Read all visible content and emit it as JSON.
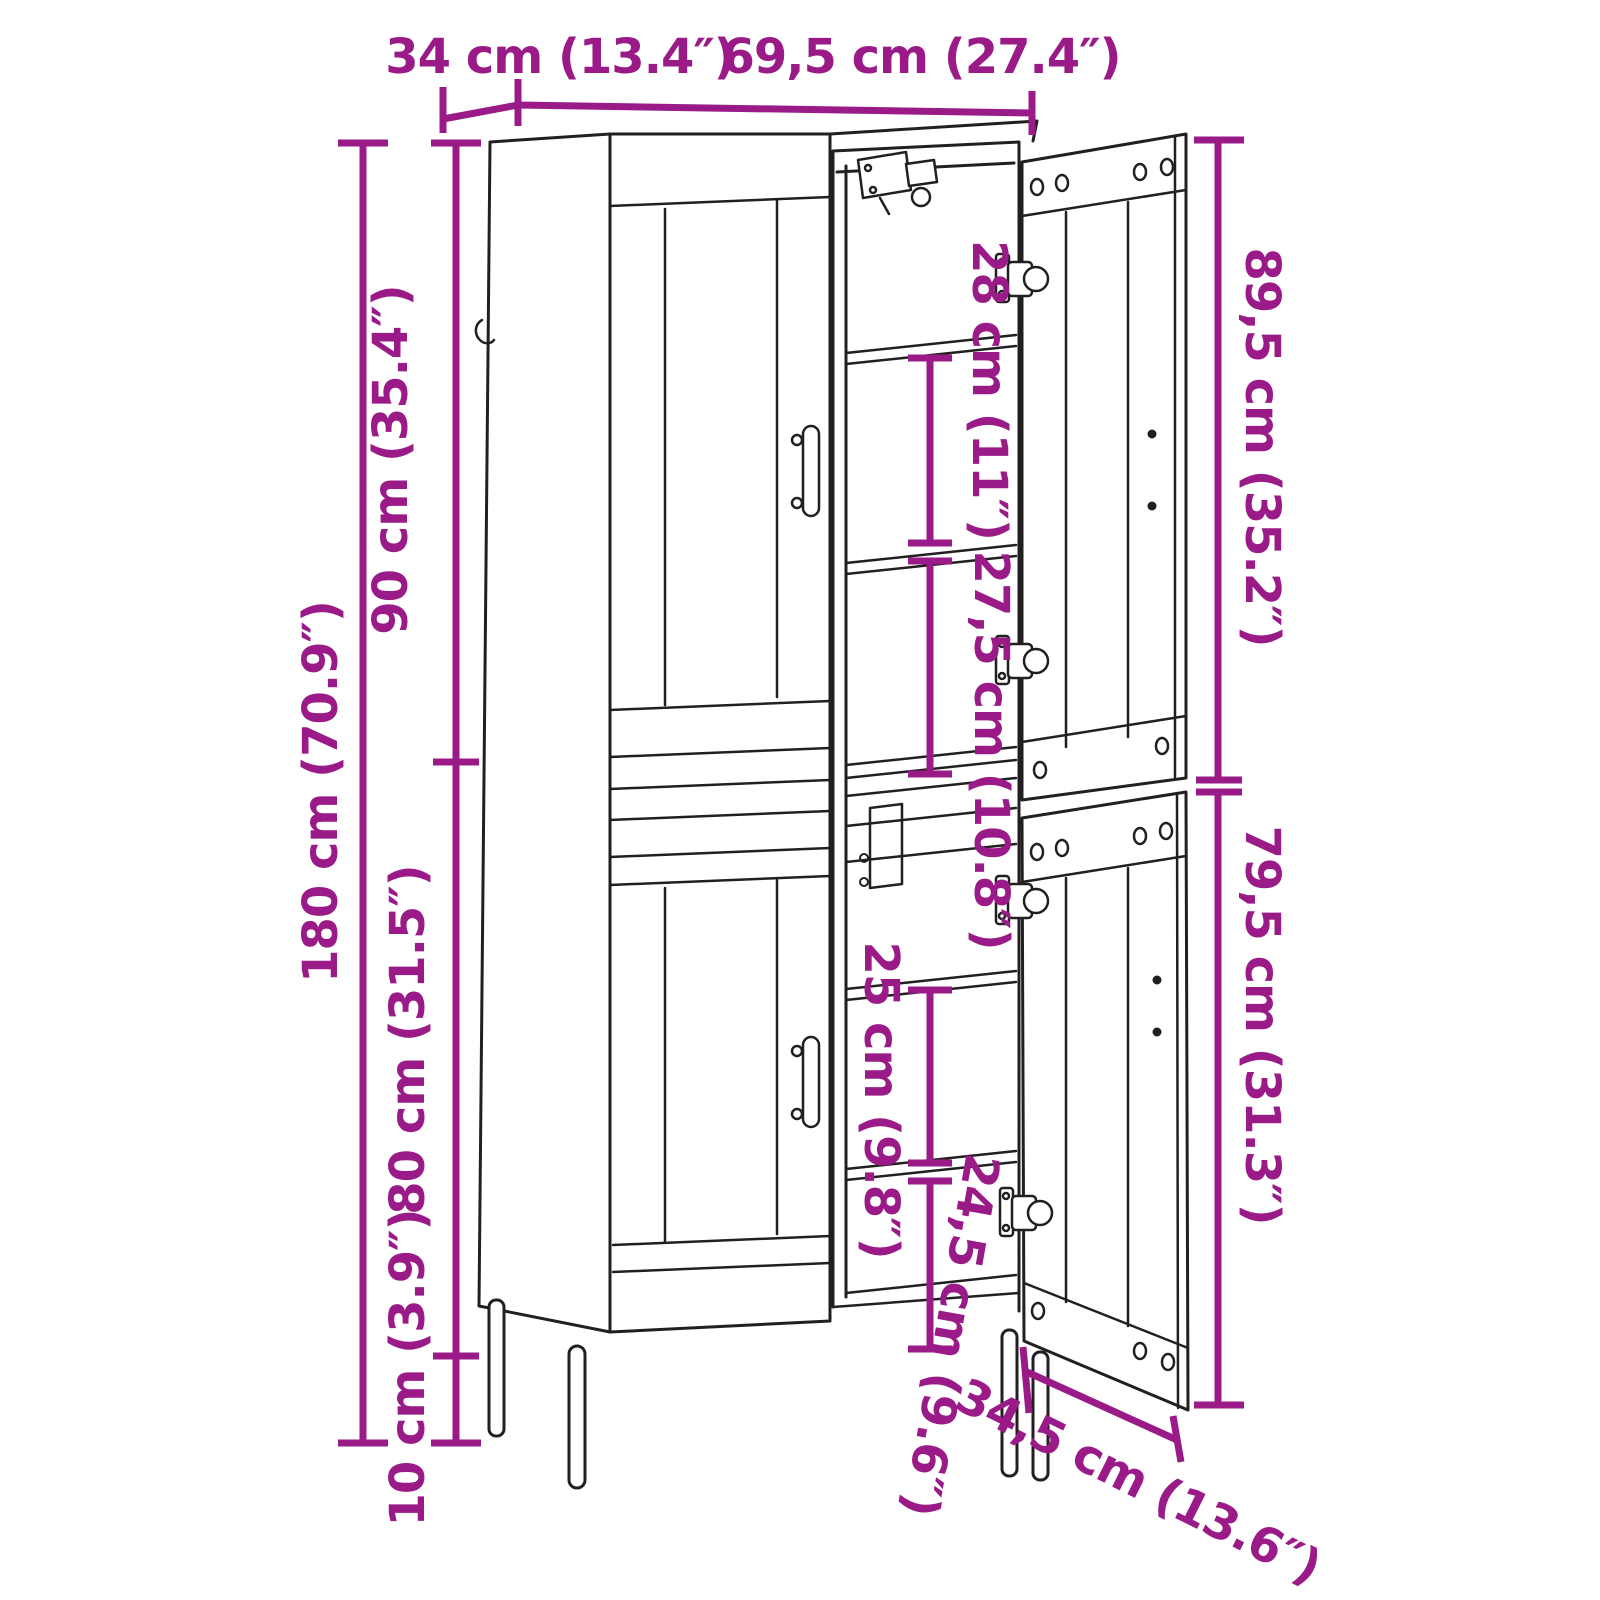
{
  "figure": {
    "type": "product-dimension-diagram",
    "subject": "tall highboard cabinet line drawing with open right-hand doors, interior shelves and metal legs",
    "background": "#ffffff",
    "line_color": "#221f20",
    "dimension_color": "#9a1b88"
  },
  "dimensions": {
    "top_depth": "34 cm (13.4″)",
    "top_width": "69,5 cm (27.4″)",
    "total_height": "180 cm (70.9″)",
    "upper_section_height": "90 cm (35.4″)",
    "lower_section_height": "80 cm (31.5″)",
    "leg_height": "10 cm (3.9″)",
    "right_upper_height": "89,5 cm (35.2″)",
    "right_lower_height": "79,5 cm (31.3″)",
    "upper_shelf_gap_1": "28 cm (11″)",
    "upper_shelf_gap_2": "27,5 cm (10.8″)",
    "lower_shelf_gap_1": "25 cm (9.8″)",
    "lower_shelf_gap_2": "24,5 cm (9.6″)",
    "base_depth": "34,5 cm (13.6″)"
  }
}
